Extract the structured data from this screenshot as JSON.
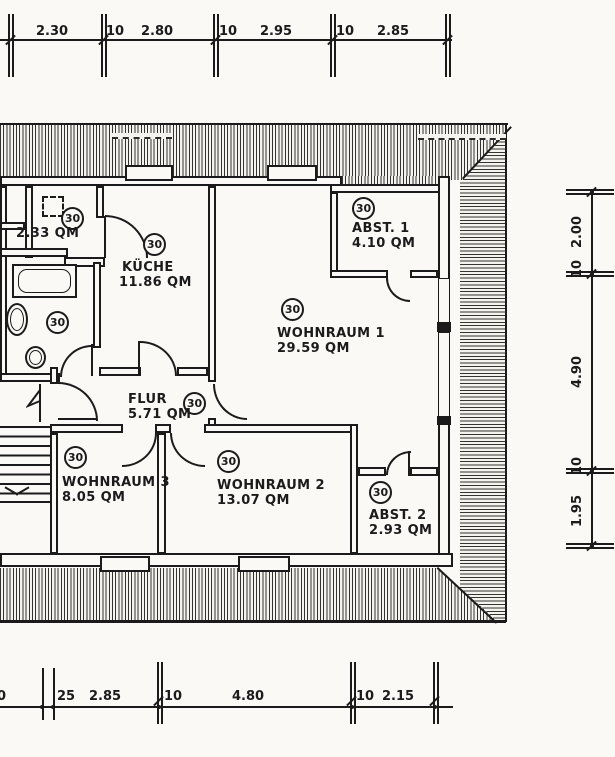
{
  "colors": {
    "paper": "#faf9f6",
    "ink": "#1b1b1b"
  },
  "rooms": [
    {
      "circle": "30",
      "name": "",
      "area": "2.33 QM"
    },
    {
      "circle": "30",
      "name": "KÜCHE",
      "area": "11.86 QM"
    },
    {
      "circle": "30",
      "name": "ABST. 1",
      "area": "4.10 QM"
    },
    {
      "circle": "30",
      "name": "WOHNRAUM 1",
      "area": "29.59 QM"
    },
    {
      "circle": "30",
      "name": "",
      "area": ""
    },
    {
      "circle": "30",
      "name": "FLUR",
      "area": "5.71 QM"
    },
    {
      "circle": "30",
      "name": "WOHNRAUM 3",
      "area": "8.05 QM"
    },
    {
      "circle": "30",
      "name": "WOHNRAUM 2",
      "area": "13.07 QM"
    },
    {
      "circle": "30",
      "name": "ABST. 2",
      "area": "2.93 QM"
    }
  ],
  "dimensions": {
    "top": {
      "labels": [
        "2.30",
        "10",
        "2.80",
        "10",
        "2.95",
        "10",
        "2.85"
      ]
    },
    "right": {
      "labels": [
        "2.00",
        "10",
        "4.90",
        "10",
        "1.95"
      ]
    },
    "bottom": {
      "labels": [
        "0",
        "25",
        "2.85",
        "10",
        "4.80",
        "10",
        "2.15"
      ]
    }
  }
}
